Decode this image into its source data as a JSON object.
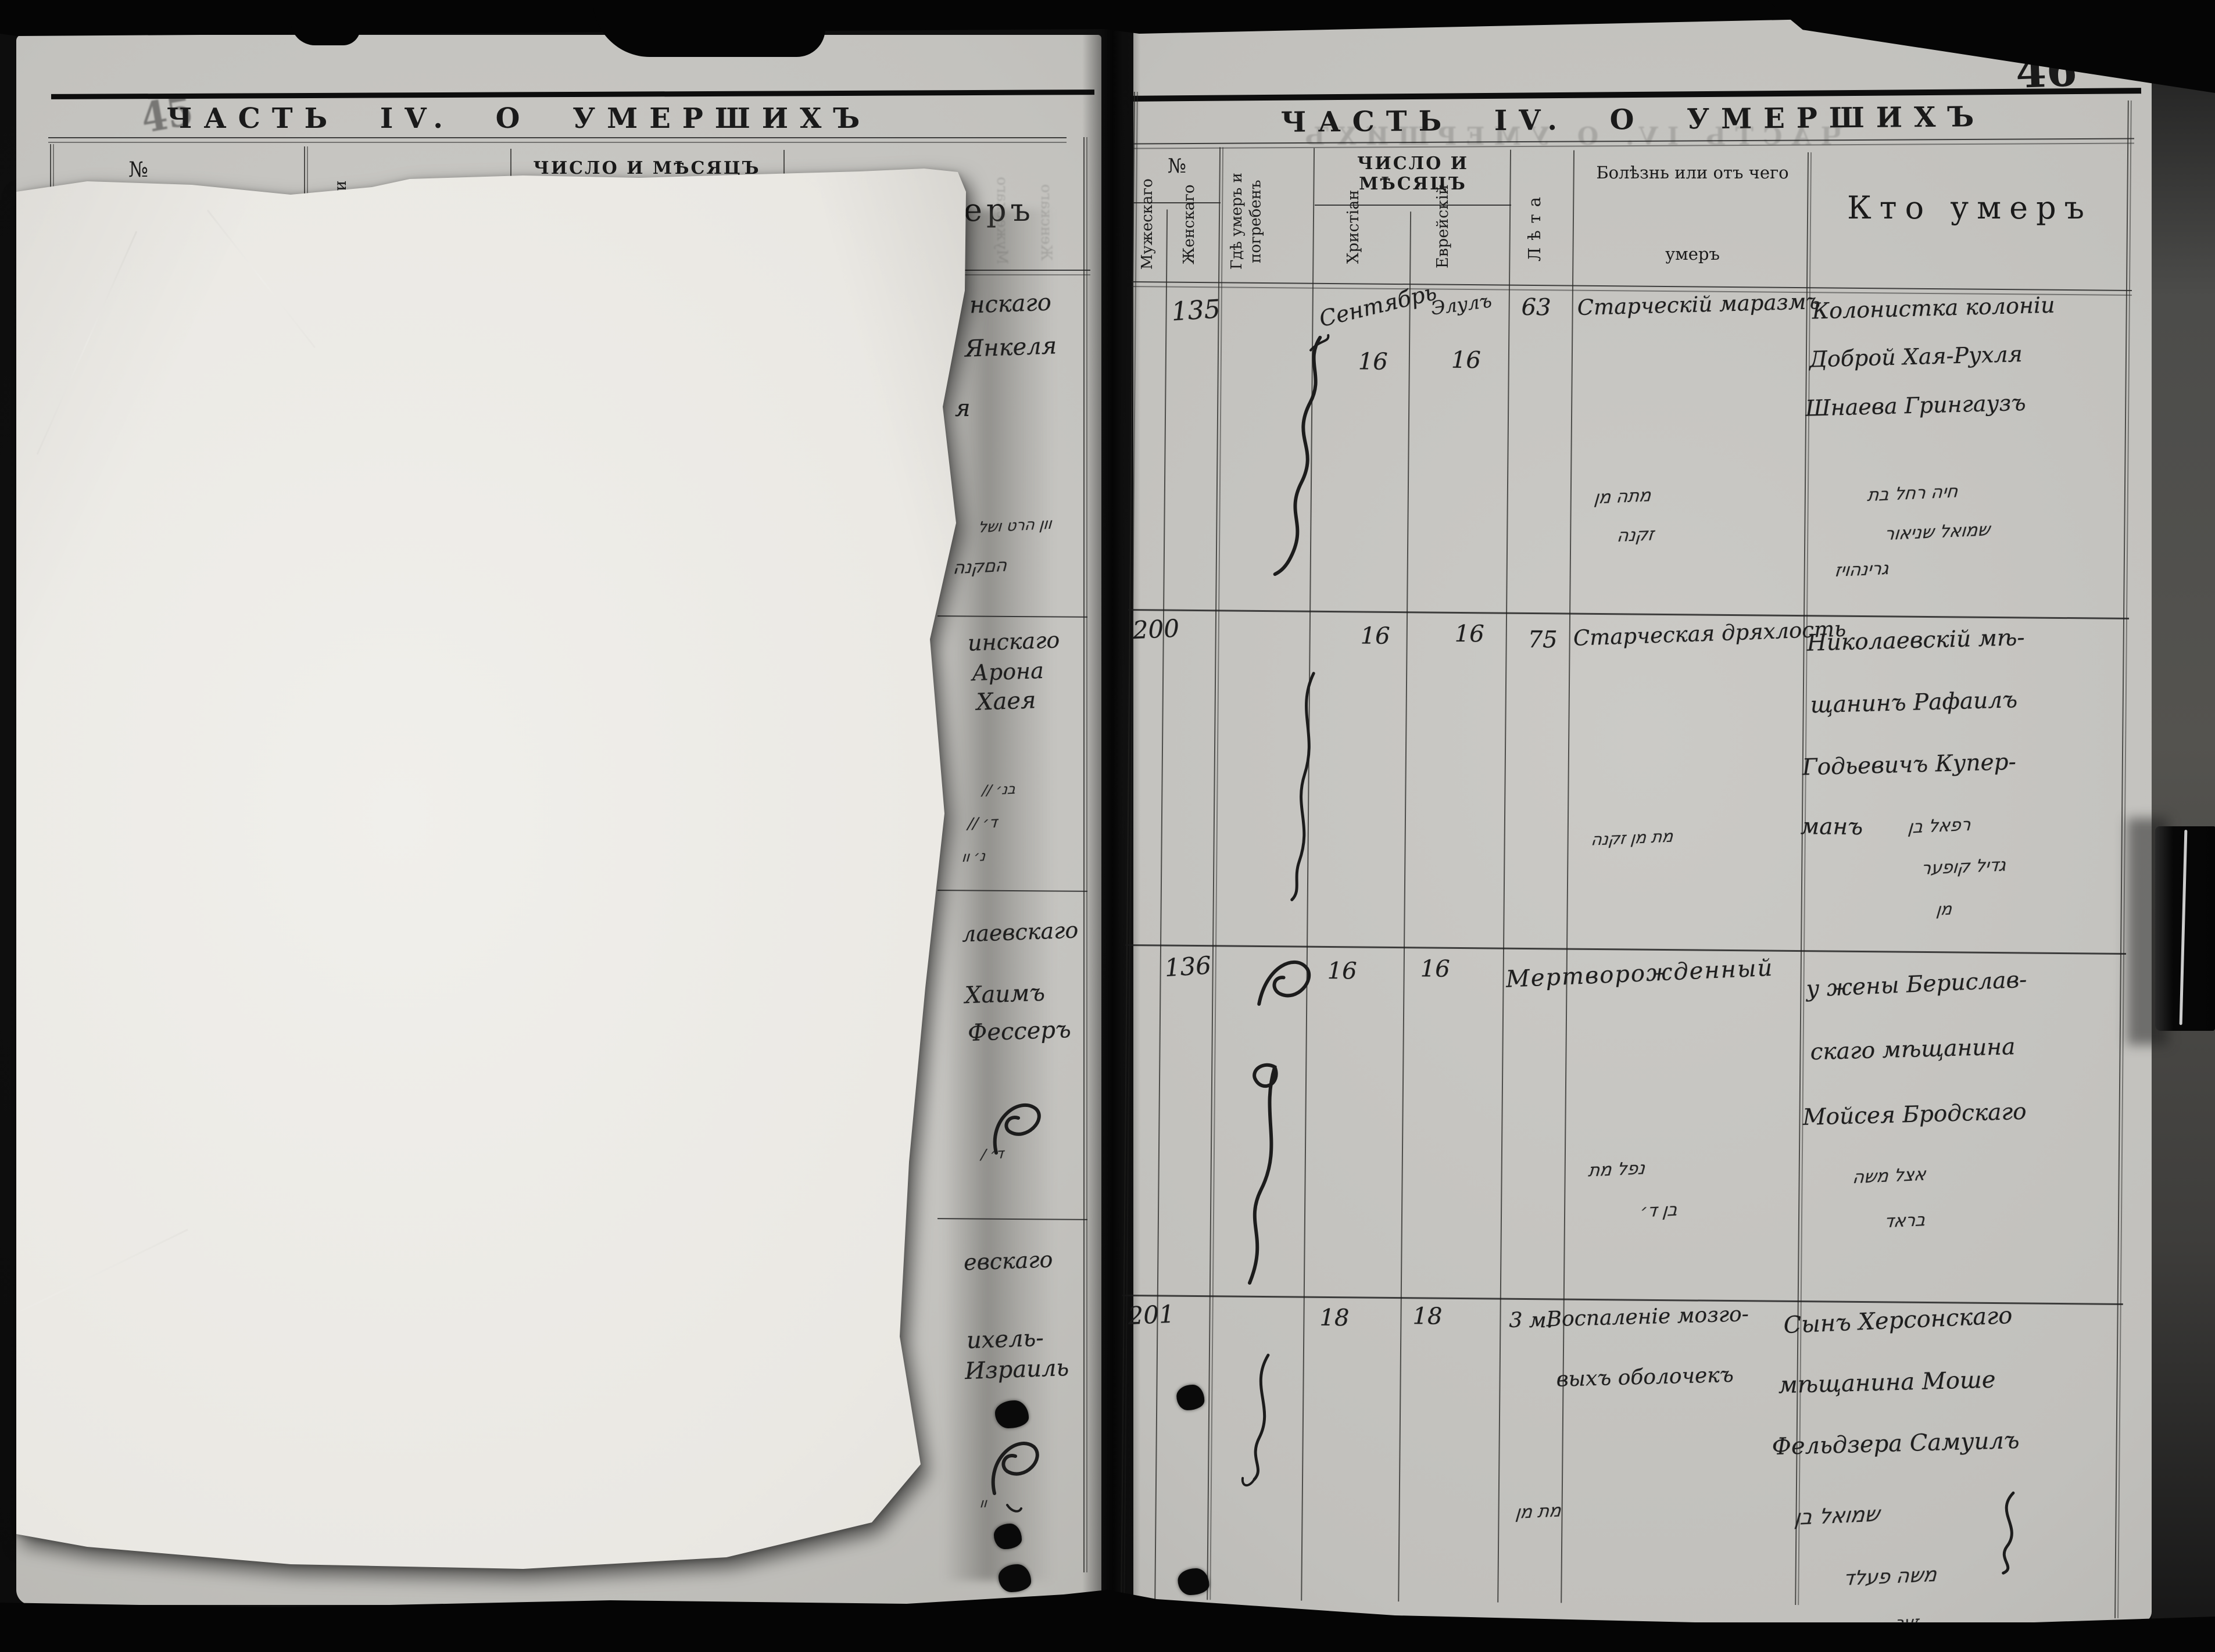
{
  "scan": {
    "page_number": "46",
    "left_stamp": "45"
  },
  "left_page": {
    "title": "ЧАСТЬ IV. О УМЕРШИХЪ",
    "headers": {
      "no": "№",
      "i_partial": "и",
      "date_group": "ЧИСЛО И МѢСЯЦЪ",
      "who_partial": "еръ"
    },
    "rows": [
      {
        "fragments": [
          "нскаго",
          "Янкеля",
          "я"
        ],
        "hebrew": [
          "וון הרט ושל",
          "הםקנה"
        ]
      },
      {
        "fragments": [
          "инскаго",
          "Арона",
          "Хаея"
        ],
        "hebrew": [
          "בנ׳ //",
          "ד׳ //",
          "נ׳ וו"
        ]
      },
      {
        "fragments": [
          "лаевскаго",
          "Хаимъ",
          "Фессеръ"
        ],
        "hebrew": [
          "ד׳ /"
        ]
      },
      {
        "fragments": [
          "евскаго",
          "ихель-",
          "Израиль"
        ],
        "hebrew": [
          "וו"
        ]
      }
    ]
  },
  "right_page": {
    "title": "ЧАСТЬ IV. О УМЕРШИХЪ",
    "columns": {
      "no_group": "№",
      "male": "Мужескаго",
      "female": "Женскаго",
      "where": "Гдѣ умеръ и погребенъ",
      "date_group": "ЧИСЛО И МѢСЯЦЪ",
      "christian": "Христіан",
      "jewish": "Еврейскій",
      "age": "Лѣта",
      "cause_l1": "Болѣзнь или отъ чего",
      "cause_l2": "умеръ",
      "who": "Кто умеръ"
    },
    "rows": [
      {
        "no_male": "",
        "no_female": "135",
        "christian_month": "Сентябрь",
        "christian_day": "16",
        "jewish_month": "Элулъ",
        "jewish_day": "16",
        "age": "63",
        "cause": "Старческій маразмъ",
        "who_lines": [
          "Колонистка колоніи",
          "Доброй Хая-Рухля",
          "Шнаева Грингаузъ"
        ],
        "hebrew_cause": [
          "מתה מן",
          "זקנה"
        ],
        "hebrew_who": [
          "חיה רחל בת",
          "שמואל שניאור",
          "גרינהויז"
        ]
      },
      {
        "no_male": "200",
        "no_female": "",
        "christian_day": "16",
        "jewish_day": "16",
        "age": "75",
        "cause": "Старческая дряхлость",
        "who_lines": [
          "Николаевскій мѣ-",
          "щанинъ Рафаилъ",
          "Годьевичъ Купер-",
          "манъ"
        ],
        "hebrew_cause": [
          "מת מן זקנה"
        ],
        "hebrew_who": [
          "רפאל בן",
          "גדיל קופער",
          "מן"
        ]
      },
      {
        "no_male": "",
        "no_female": "136",
        "christian_day": "16",
        "jewish_day": "16",
        "age": "",
        "cause": "Мертворожденный",
        "who_lines": [
          "у жены Берислав-",
          "скаго мѣщанина",
          "Мойсея Бродскаго"
        ],
        "hebrew_cause": [
          "נפל מת",
          "בן ד׳"
        ],
        "hebrew_who": [
          "אצל משה",
          "בראד"
        ]
      },
      {
        "no_male": "201",
        "no_female": "",
        "christian_day": "18",
        "jewish_day": "18",
        "age": "3 м.",
        "cause_lines": [
          "Воспаленіе мозго-",
          "выхъ оболочекъ"
        ],
        "who_lines": [
          "Сынъ Херсонскаго",
          "мѣщанина Моше",
          "Фельдзера Самуилъ"
        ],
        "hebrew_cause": [
          "מת מן"
        ],
        "hebrew_who": [
          "שמואל בן",
          "משה פעלד",
          "זער"
        ]
      }
    ]
  }
}
